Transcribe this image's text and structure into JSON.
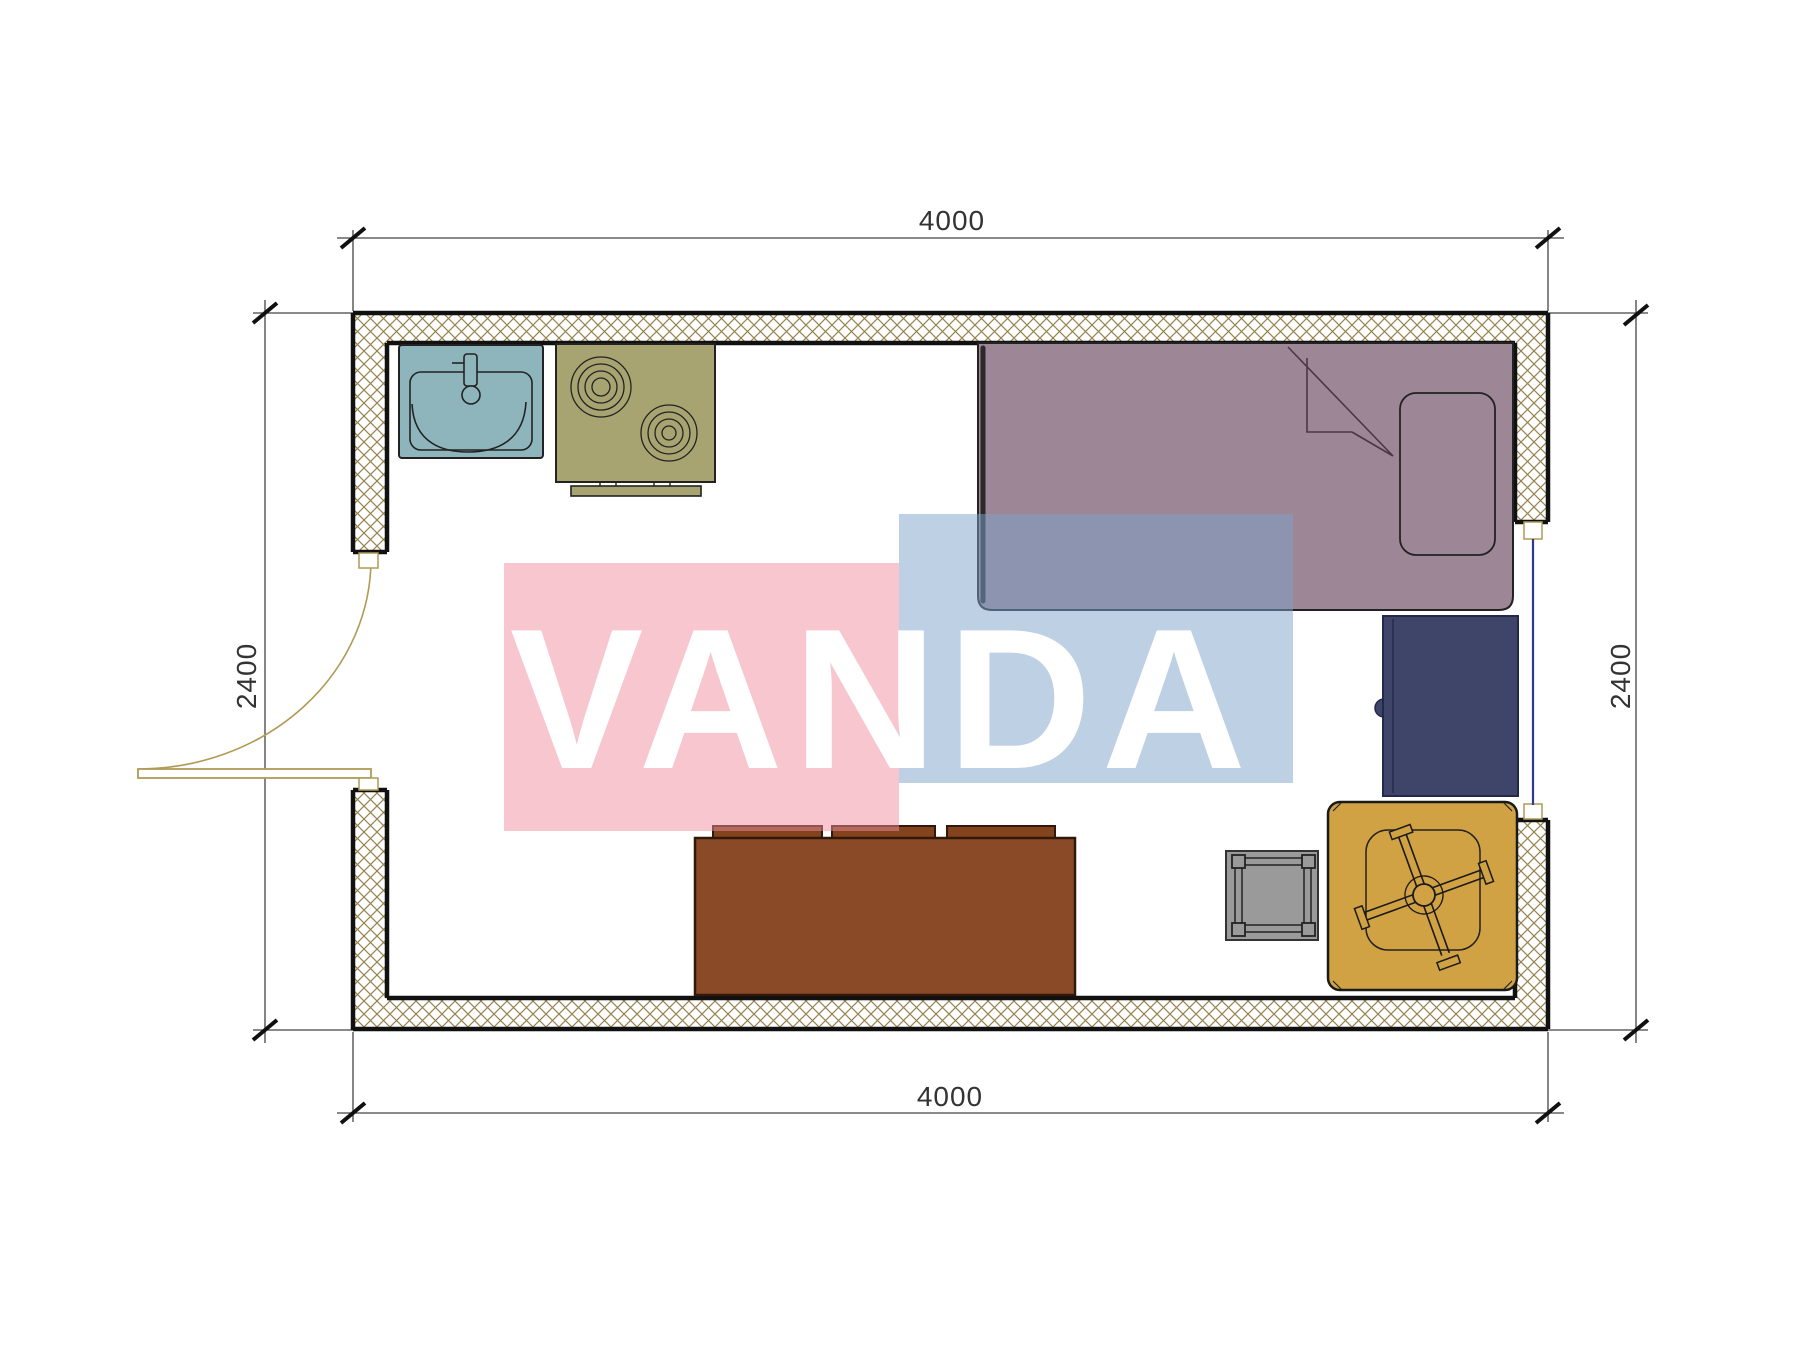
{
  "watermark": {
    "text": "VANDA",
    "pink": "#ef8d9d",
    "blue": "#7da1c9"
  },
  "dimensions": {
    "top": "4000",
    "bottom": "4000",
    "left": "2400",
    "right": "2400"
  },
  "colors": {
    "wall_hatch": "#97834e",
    "wall_line": "#111111",
    "dim_line": "#444444",
    "dim_text": "#2a2a2a",
    "sink": "#8fb5bc",
    "stove": "#a7a471",
    "bed": "#9d8695",
    "bed_edge": "#2a2a2a",
    "desk": "#3f4569",
    "sofa": "#8a4a28",
    "sofa_cushion": "#82431d",
    "stool": "#9a9a9a",
    "chair": "#d1a243",
    "door": "#b09a55",
    "window": "#2e3a8c"
  }
}
